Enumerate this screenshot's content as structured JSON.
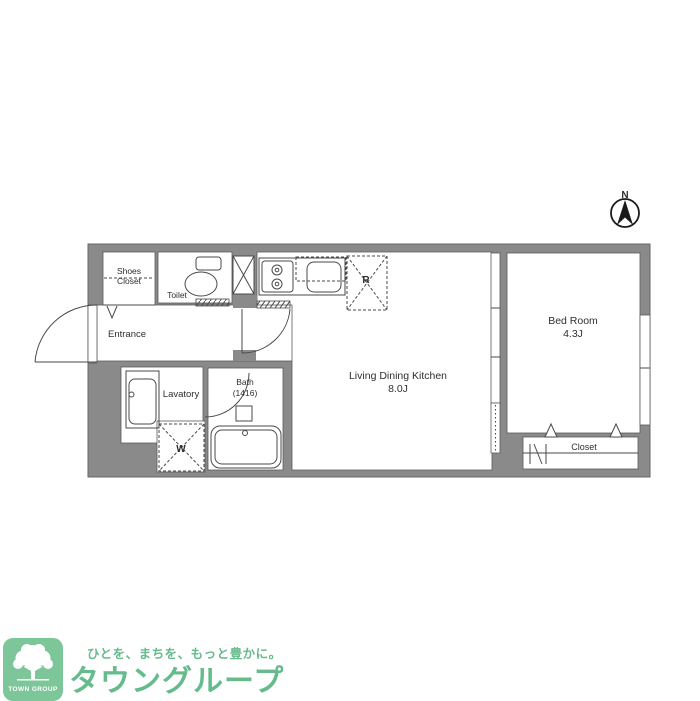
{
  "compass": {
    "north_label": "N"
  },
  "floorplan": {
    "shoes_closet": {
      "line1": "Shoes",
      "line2": "Closet"
    },
    "toilet_label": "Toilet",
    "entrance_label": "Entrance",
    "lavatory_label": "Lavatory",
    "bath": {
      "line1": "Bath",
      "line2": "(1416)"
    },
    "washer_label": "W",
    "fridge_label": "R",
    "ldk": {
      "line1": "Living Dining Kitchen",
      "line2": "8.0J"
    },
    "bedroom": {
      "line1": "Bed Room",
      "line2": "4.3J"
    },
    "closet_label": "Closet"
  },
  "logo": {
    "brand_square_text": "TOWN GROUP",
    "tagline": "ひとを、まちを、もっと豊かに。",
    "brand_name": "タウングループ",
    "green": "#7cc69a",
    "text_green": "#65bb8c"
  },
  "colors": {
    "wall": "#8a8a8a",
    "line": "#4a4a4a"
  }
}
